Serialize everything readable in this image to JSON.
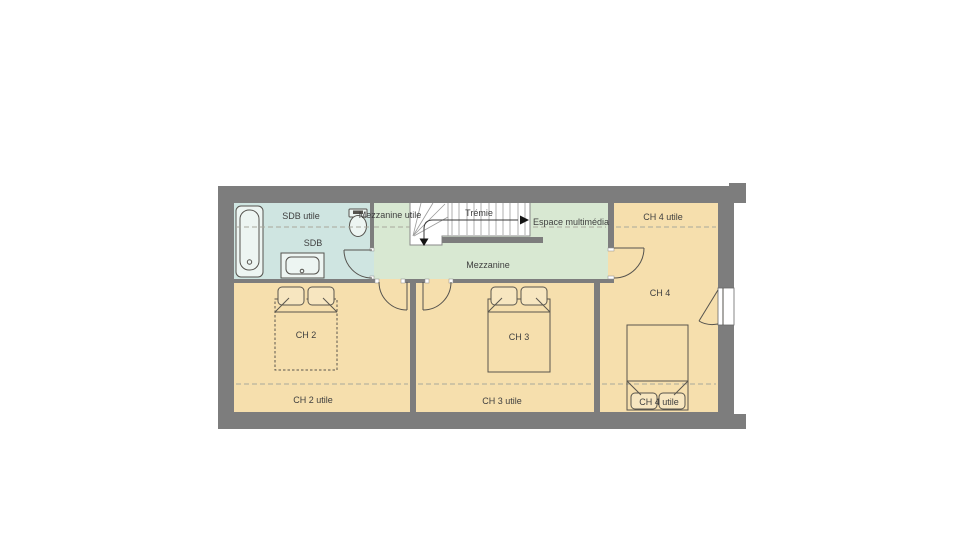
{
  "floorplan": {
    "labels": {
      "sdb_utile": "SDB utile",
      "sdb": "SDB",
      "mezzanine_utile": "Mezzanine utile",
      "tremie": "Trémie",
      "espace_multimedia": "Espace multimédia",
      "ch4_utile_haut": "CH 4 utile",
      "mezzanine": "Mezzanine",
      "ch4": "CH 4",
      "ch2": "CH 2",
      "ch3": "CH 3",
      "ch2_utile": "CH 2 utile",
      "ch3_utile": "CH 3 utile",
      "ch4_utile_bas": "CH 4 utile"
    },
    "colors": {
      "wall": "#7d7d7d",
      "bedroom_floor": "#f6dfad",
      "bathroom_floor": "#cfe5e1",
      "mezzanine_floor": "#d8e8d2",
      "stair_fill": "#ffffff",
      "text": "#3f3f3f",
      "background": "#ffffff"
    }
  }
}
